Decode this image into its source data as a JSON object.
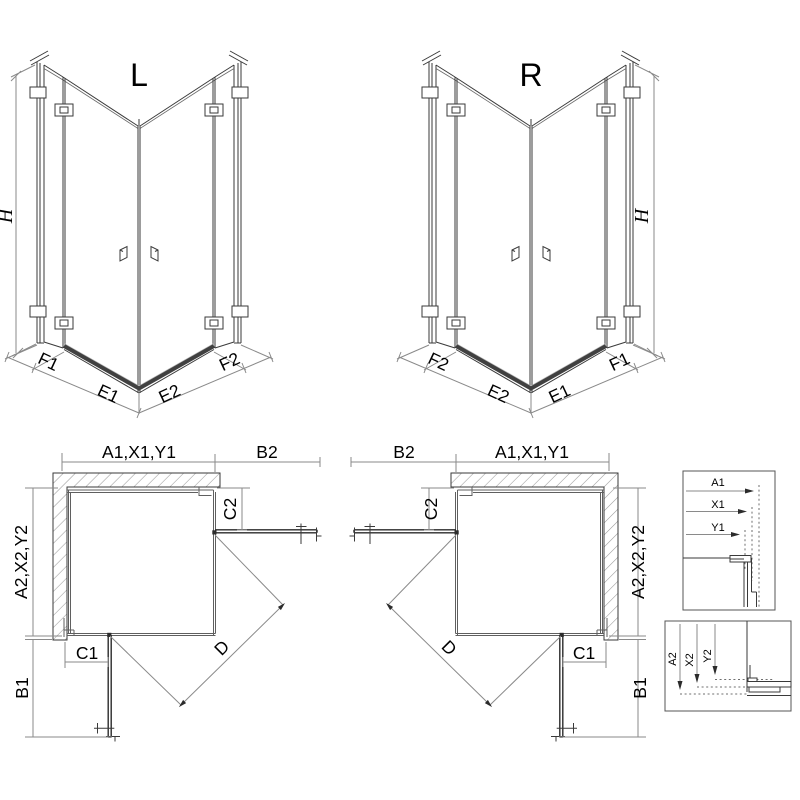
{
  "iso_left": {
    "label": "L",
    "height_dim": "H",
    "bottom_dims": [
      "F1",
      "E1",
      "E2",
      "F2"
    ]
  },
  "iso_right": {
    "label": "R",
    "height_dim": "H",
    "bottom_dims": [
      "F2",
      "E2",
      "E1",
      "F1"
    ]
  },
  "plan_left": {
    "width_dim": "A1,X1,Y1",
    "door_return_dim": "B2",
    "fixed_panel_top_dim": "C2",
    "depth_dim": "A2,X2,Y2",
    "fixed_panel_side_dim": "C1",
    "door_return_side_dim": "B1",
    "diagonal_entry_dim": "D"
  },
  "plan_right": {
    "width_dim": "A1,X1,Y1",
    "door_return_dim": "B2",
    "fixed_panel_top_dim": "C2",
    "depth_dim": "A2,X2,Y2",
    "fixed_panel_side_dim": "C1",
    "door_return_side_dim": "B1",
    "diagonal_entry_dim": "D"
  },
  "detail_width": {
    "dims": [
      "A1",
      "X1",
      "Y1"
    ]
  },
  "detail_depth": {
    "dims": [
      "A2",
      "X2",
      "Y2"
    ]
  },
  "colors": {
    "background": "#ffffff",
    "main_line": "#3a3a3a",
    "dimension_line": "#8a8a8a",
    "hatch": "#9a9a9a",
    "threshold": "#404040"
  }
}
